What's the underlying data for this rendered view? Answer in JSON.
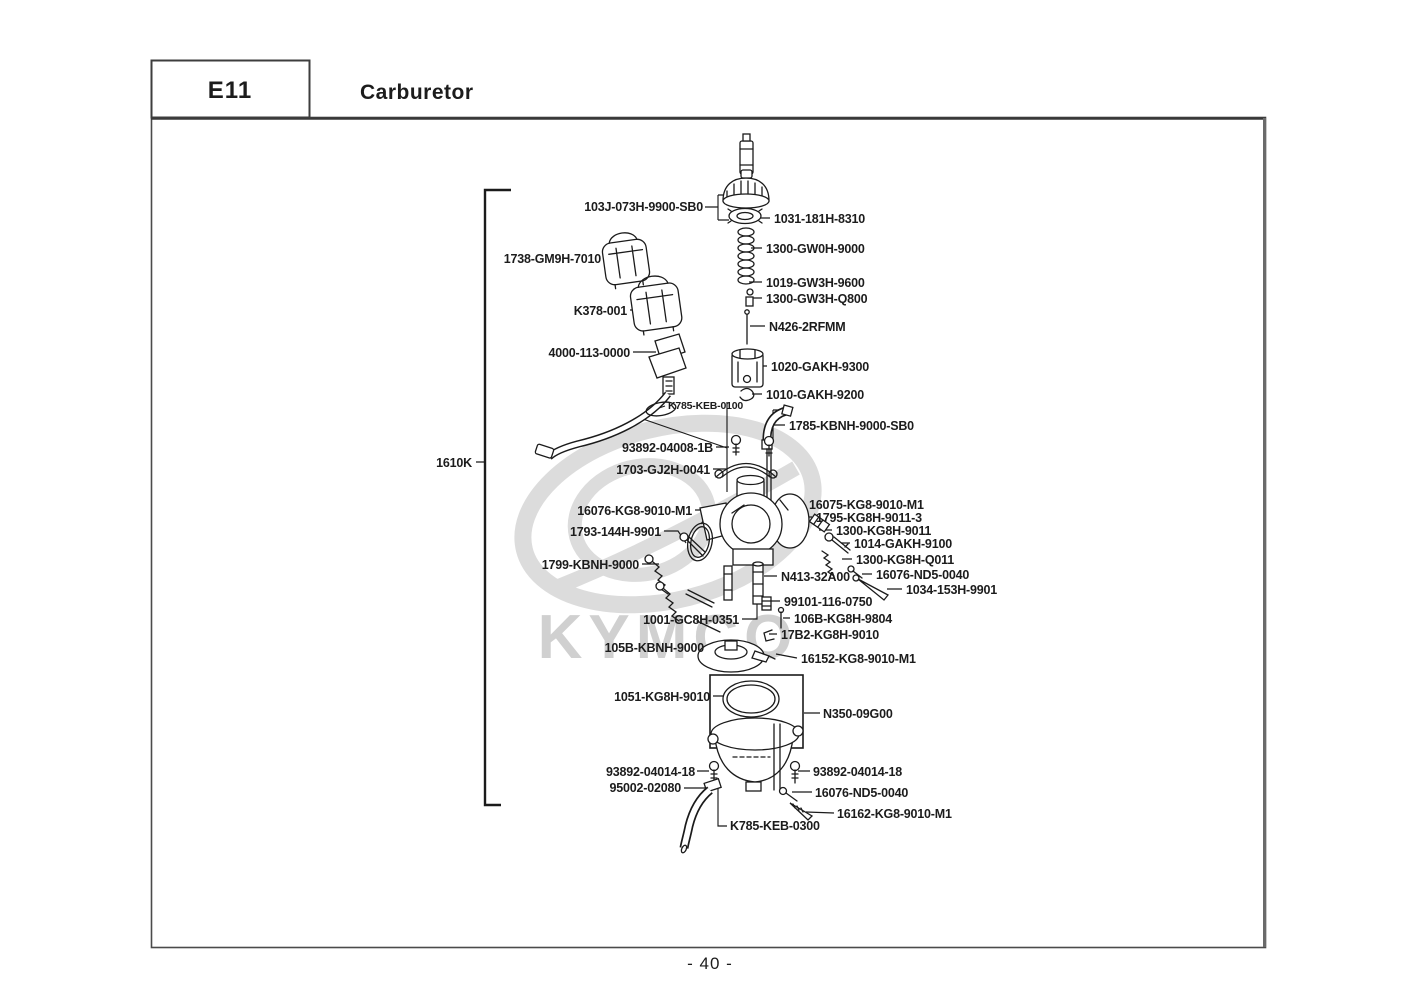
{
  "header": {
    "code": "E11",
    "title": "Carburetor"
  },
  "footer": {
    "page_number": "- 40 -"
  },
  "watermark": {
    "brand": "KYMCO"
  },
  "diagram": {
    "group_label": "1610K",
    "parts": [
      {
        "label": "103J-073H-9900-SB0"
      },
      {
        "label": "1738-GM9H-7010"
      },
      {
        "label": "K378-001"
      },
      {
        "label": "4000-113-0000"
      },
      {
        "label": "1031-181H-8310"
      },
      {
        "label": "1300-GW0H-9000"
      },
      {
        "label": "1019-GW3H-9600"
      },
      {
        "label": "1300-GW3H-Q800"
      },
      {
        "label": "N426-2RFMM"
      },
      {
        "label": "1020-GAKH-9300"
      },
      {
        "label": "1010-GAKH-9200"
      },
      {
        "label": "K785-KEB-0100"
      },
      {
        "label": "1785-KBNH-9000-SB0"
      },
      {
        "label": "93892-04008-1B"
      },
      {
        "label": "1703-GJ2H-0041"
      },
      {
        "label": "16076-KG8-9010-M1"
      },
      {
        "label": "1793-144H-9901"
      },
      {
        "label": "1799-KBNH-9000"
      },
      {
        "label": "16075-KG8-9010-M1"
      },
      {
        "label": "1795-KG8H-9011-3"
      },
      {
        "label": "1300-KG8H-9011"
      },
      {
        "label": "1014-GAKH-9100"
      },
      {
        "label": "1300-KG8H-Q011"
      },
      {
        "label": "16076-ND5-0040"
      },
      {
        "label": "1034-153H-9901"
      },
      {
        "label": "N413-32A00"
      },
      {
        "label": "99101-116-0750"
      },
      {
        "label": "1001-GC8H-0351"
      },
      {
        "label": "106B-KG8H-9804"
      },
      {
        "label": "17B2-KG8H-9010"
      },
      {
        "label": "105B-KBNH-9000"
      },
      {
        "label": "16152-KG8-9010-M1"
      },
      {
        "label": "1051-KG8H-9010"
      },
      {
        "label": "N350-09G00"
      },
      {
        "label": "93892-04014-18"
      },
      {
        "label": "93892-04014-18"
      },
      {
        "label": "95002-02080"
      },
      {
        "label": "16076-ND5-0040"
      },
      {
        "label": "16162-KG8-9010-M1"
      },
      {
        "label": "K785-KEB-0300"
      }
    ]
  }
}
